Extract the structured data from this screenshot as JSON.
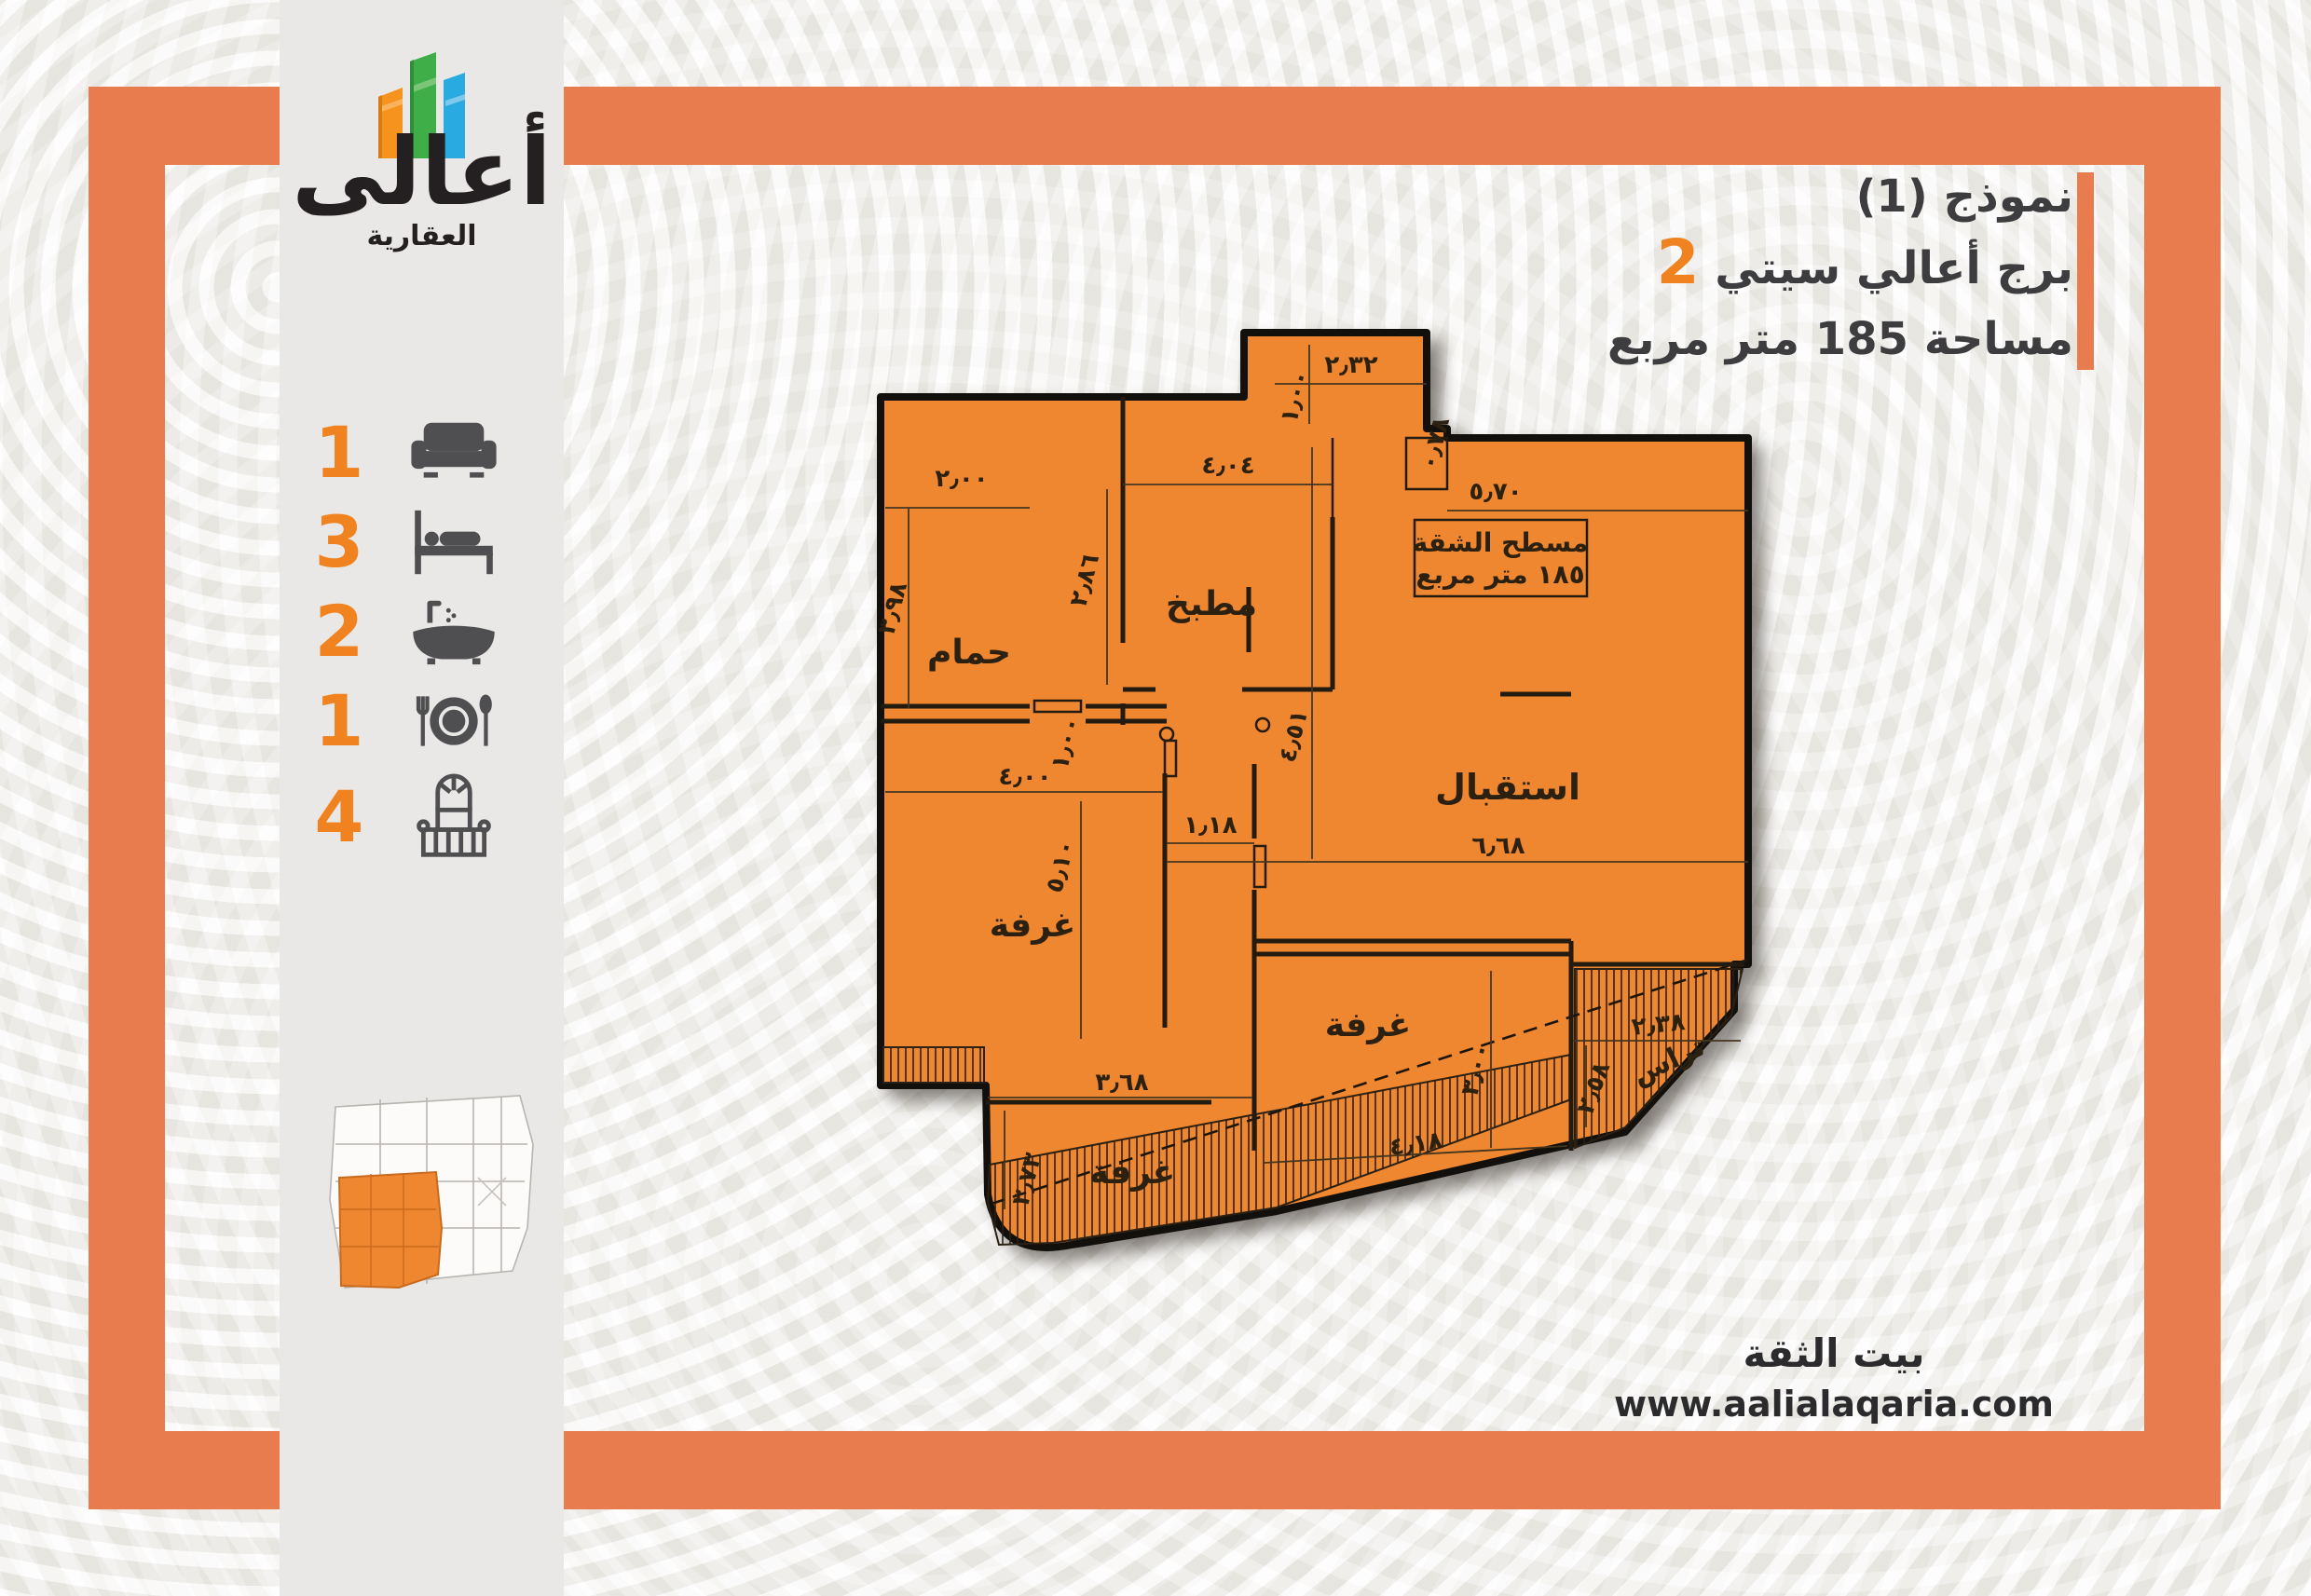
{
  "colors": {
    "frame_orange": "#e87c4e",
    "plan_orange": "#ef8630",
    "accent_orange": "#f0831f",
    "icon_gray": "#4f4f51",
    "text_dark": "#3d3d3f"
  },
  "logo": {
    "name": "أعالى",
    "sub": "العقارية"
  },
  "headline": {
    "model": "نموذج (1)",
    "project": "برج أعالي سيتي",
    "project_num": "2",
    "area_line": "مساحة 185 متر مربع"
  },
  "amenities": [
    {
      "count": "1",
      "icon": "sofa-icon"
    },
    {
      "count": "3",
      "icon": "bed-icon"
    },
    {
      "count": "2",
      "icon": "bathtub-icon"
    },
    {
      "count": "1",
      "icon": "dining-icon"
    },
    {
      "count": "4",
      "icon": "balcony-icon"
    }
  ],
  "plan": {
    "rooms": {
      "hammam": "حمام",
      "kitchen": "مطبخ",
      "reception": "استقبال",
      "room": "غرفة",
      "terrace": "تراس"
    },
    "area_box": {
      "line1": "مسطح الشقة",
      "line2": "١٨٥ متر مربع"
    },
    "dims": {
      "d232": "٢٫٣٢",
      "d100a": "١٫٠٠",
      "d078": "٠٫٧٨",
      "d200": "٢٫٠٠",
      "d398": "٣٫٩٨",
      "d404": "٤٫٠٤",
      "d286": "٢٫٨٦",
      "d100b": "١٫٠٠",
      "d570": "٥٫٧٠",
      "d451": "٤٫٥١",
      "d118": "١٫١٨",
      "d668": "٦٫٦٨",
      "d400": "٤٫٠٠",
      "d510": "٥٫١٠",
      "d368": "٣٫٦٨",
      "d373": "٣٫٧٣",
      "d418": "٤٫١٨",
      "d300": "٣٫٠٠",
      "d238": "٢٫٣٨",
      "d258": "٢٫٥٨"
    }
  },
  "footer": {
    "slogan": "بيت الثقة",
    "website": "www.aalialaqaria.com"
  }
}
